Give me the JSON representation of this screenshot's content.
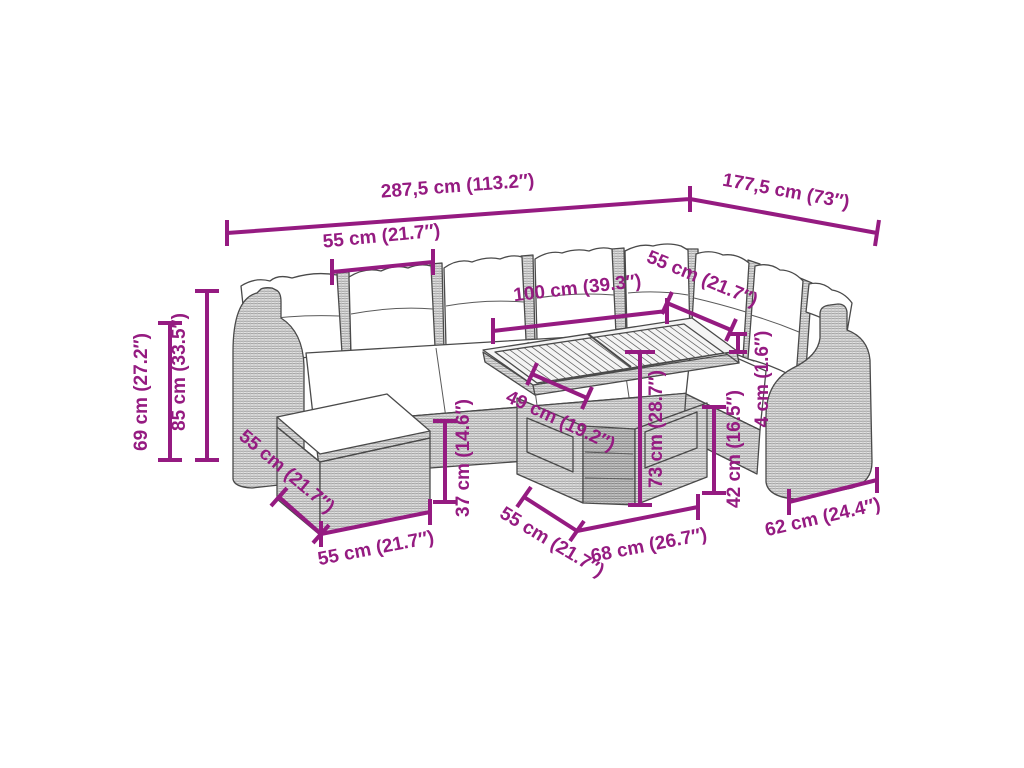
{
  "meta": {
    "title": "Garden lounge set dimension diagram",
    "depicted_object": "modular poly-rattan lounge set with cushions, footstool and slat-top table",
    "accent_color": "#951b81",
    "line_art_color": "#4a4a4a"
  },
  "annotations": [
    {
      "id": "total-length",
      "label": "287,5 cm (113.2″)"
    },
    {
      "id": "total-depth",
      "label": "177,5 cm (73″)"
    },
    {
      "id": "module-width-top",
      "label": "55 cm (21.7″)"
    },
    {
      "id": "module-width-right",
      "label": "55 cm (21.7″)"
    },
    {
      "id": "table-top-length",
      "label": "100 cm (39.3″)"
    },
    {
      "id": "armrest-height",
      "label": "69 cm (27.2″)"
    },
    {
      "id": "total-height",
      "label": "85 cm (33.5″)"
    },
    {
      "id": "footstool-depth",
      "label": "55 cm (21.7″)"
    },
    {
      "id": "footstool-width",
      "label": "55 cm (21.7″)"
    },
    {
      "id": "seat-height",
      "label": "37 cm (14.6″)"
    },
    {
      "id": "under-table-clearance",
      "label": "49 cm (19.2″)"
    },
    {
      "id": "table-height",
      "label": "73 cm (28.7″)"
    },
    {
      "id": "seat-height-front",
      "label": "42 cm (16.5″)"
    },
    {
      "id": "cushion-thickness",
      "label": "4 cm (1.6″)"
    },
    {
      "id": "armrest-module-width",
      "label": "62 cm (24.4″)"
    },
    {
      "id": "table-depth",
      "label": "55 cm (21.7″)"
    },
    {
      "id": "table-base-width",
      "label": "68 cm (26.7″)"
    }
  ]
}
